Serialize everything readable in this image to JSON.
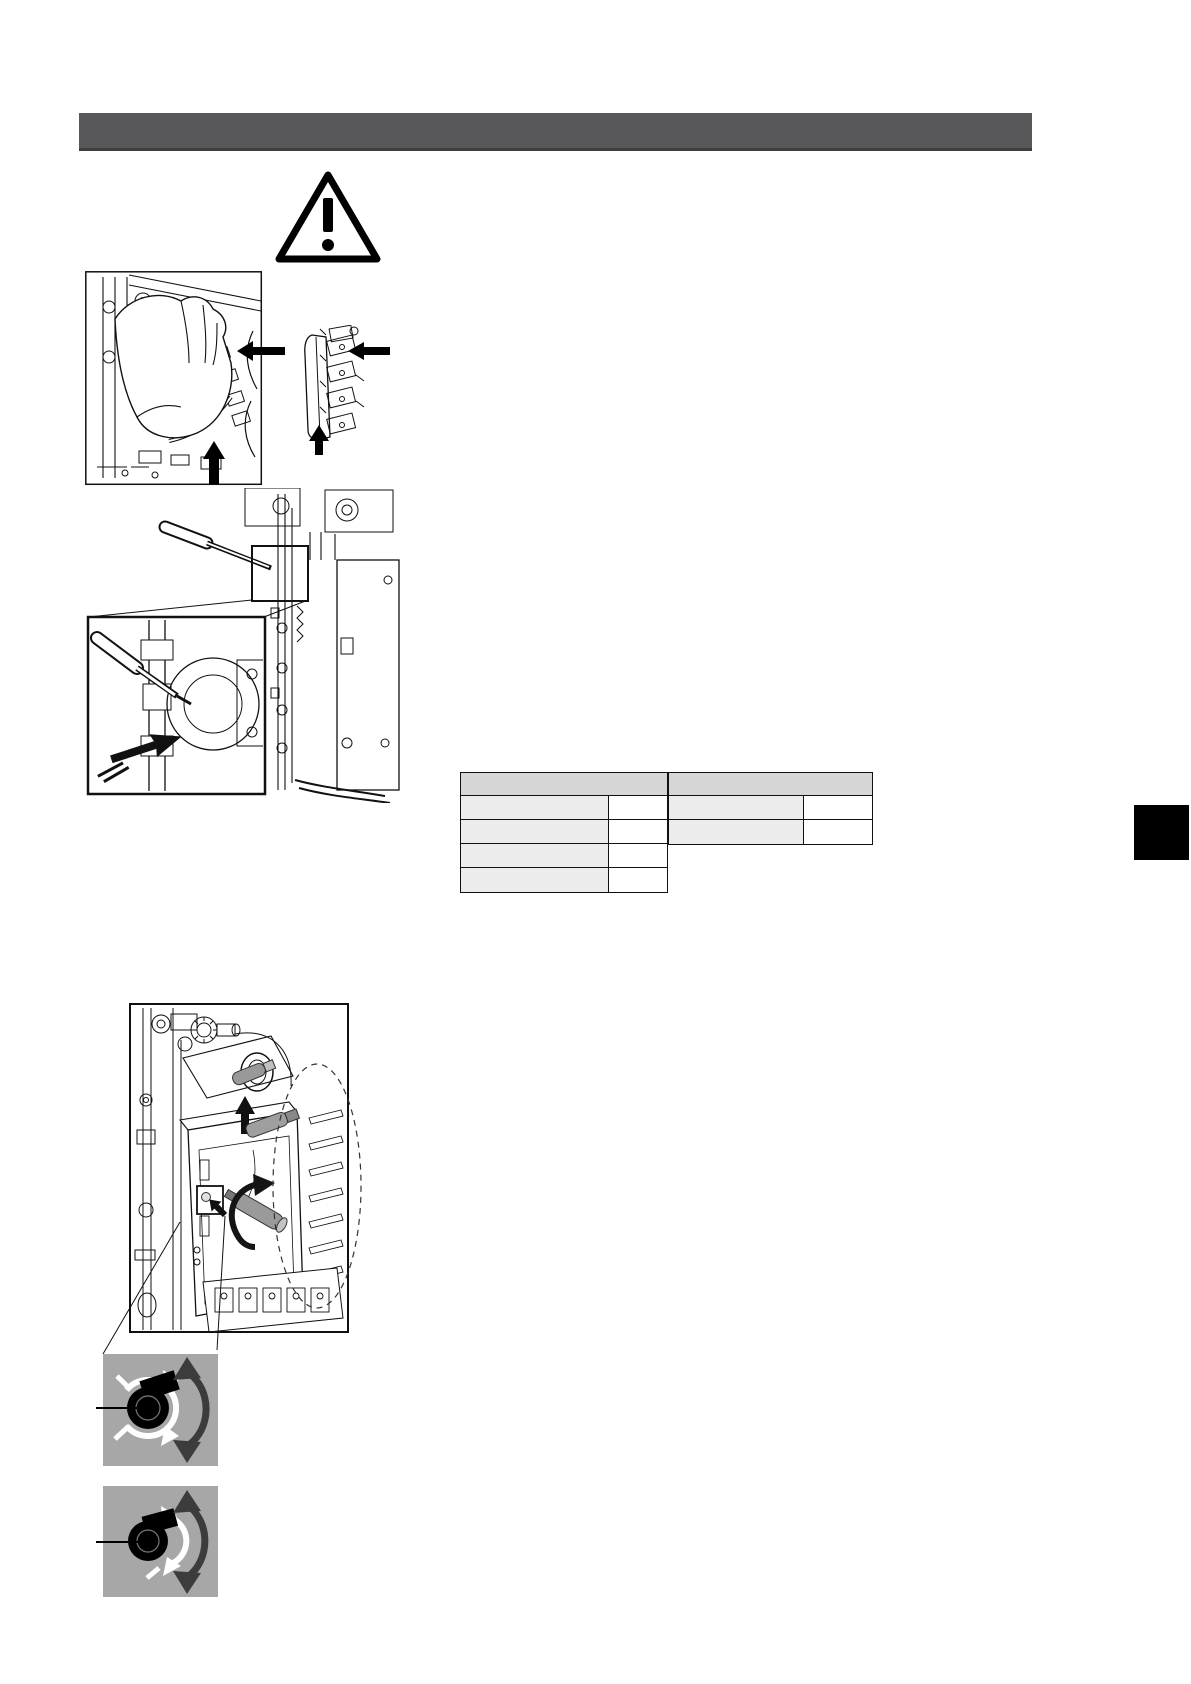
{
  "page": {
    "kind": "installation-manual-page",
    "background": "#ffffff",
    "visible_text": ""
  },
  "header_bar": {
    "title": "",
    "color": "#58585a"
  },
  "icons": {
    "warning": {
      "name": "warning-triangle-icon",
      "glyph": "!",
      "color": "#000000"
    },
    "direction_arrows": {
      "name": "direction-arrow",
      "color": "#000000"
    },
    "rotation_arrow": {
      "name": "rotation-arrow",
      "color": "#151515"
    }
  },
  "figures": {
    "fig1": {
      "name": "hand-removing-connector-block"
    },
    "fig2": {
      "name": "connector-terminal-strip"
    },
    "fig3": {
      "name": "screwdriver-on-component-with-magnified-inset"
    },
    "fig4": {
      "name": "control-box-with-screw-and-tool"
    }
  },
  "parameter_tables": {
    "colors": {
      "header_bg": "#d6d6d6",
      "label_bg": "#ececec",
      "value_bg": "#ffffff",
      "border": "#111111"
    },
    "left": {
      "header": "",
      "rows": [
        {
          "label": "",
          "value": ""
        },
        {
          "label": "",
          "value": ""
        },
        {
          "label": "",
          "value": ""
        },
        {
          "label": "",
          "value": ""
        }
      ]
    },
    "right": {
      "header": "",
      "rows": [
        {
          "label": "",
          "value": ""
        },
        {
          "label": "",
          "value": ""
        }
      ]
    }
  },
  "side_tab": {
    "label": "",
    "color": "#000000"
  },
  "knob_diagrams": {
    "panel_color": "#a7a7a7",
    "knob_color": "#000000",
    "indicator_color": "#ffffff",
    "arrow_color": "#3c3c3c",
    "items": [
      {
        "name": "knob-rotation-position-1",
        "label": ""
      },
      {
        "name": "knob-rotation-position-2",
        "label": ""
      }
    ]
  }
}
